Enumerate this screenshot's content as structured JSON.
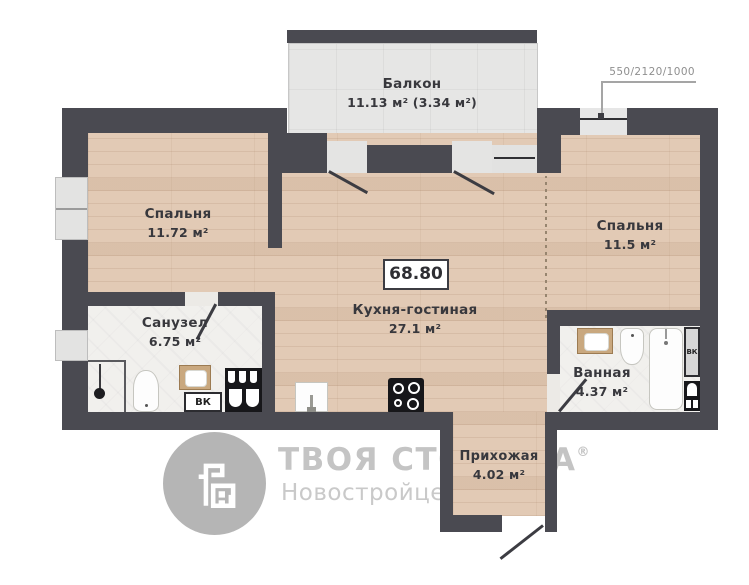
{
  "plan": {
    "total_area": "68.80",
    "dimension_note": "550/2120/1000",
    "rooms": {
      "balcony": {
        "name": "Балкон",
        "area": "11.13 м² (3.34 м²)"
      },
      "bedroom_left": {
        "name": "Спальня",
        "area": "11.72 м²"
      },
      "bedroom_right": {
        "name": "Спальня",
        "area": "11.5 м²"
      },
      "kitchen_living": {
        "name": "Кухня-гостиная",
        "area": "27.1 м²"
      },
      "bathroom_left": {
        "name": "Санузел",
        "area": "6.75 м²"
      },
      "bathroom_right": {
        "name": "Ванная",
        "area": "4.37 м²"
      },
      "hallway": {
        "name": "Прихожая",
        "area": "4.02 м²"
      }
    },
    "shafts": [
      {
        "label": "ВК"
      },
      {
        "label": "ВК"
      }
    ]
  },
  "watermark": {
    "brand": "ТВОЯ СТОЛИЦА",
    "reg": "®",
    "subtitle": "Новостройцентр"
  },
  "colors": {
    "wall": "#4a4a51",
    "wood_floor": "#e2cab5",
    "balcony_tile": "#e6e6e5",
    "bath_tile": "#f1f0ed",
    "watermark_gray": "#c4c4c4"
  }
}
